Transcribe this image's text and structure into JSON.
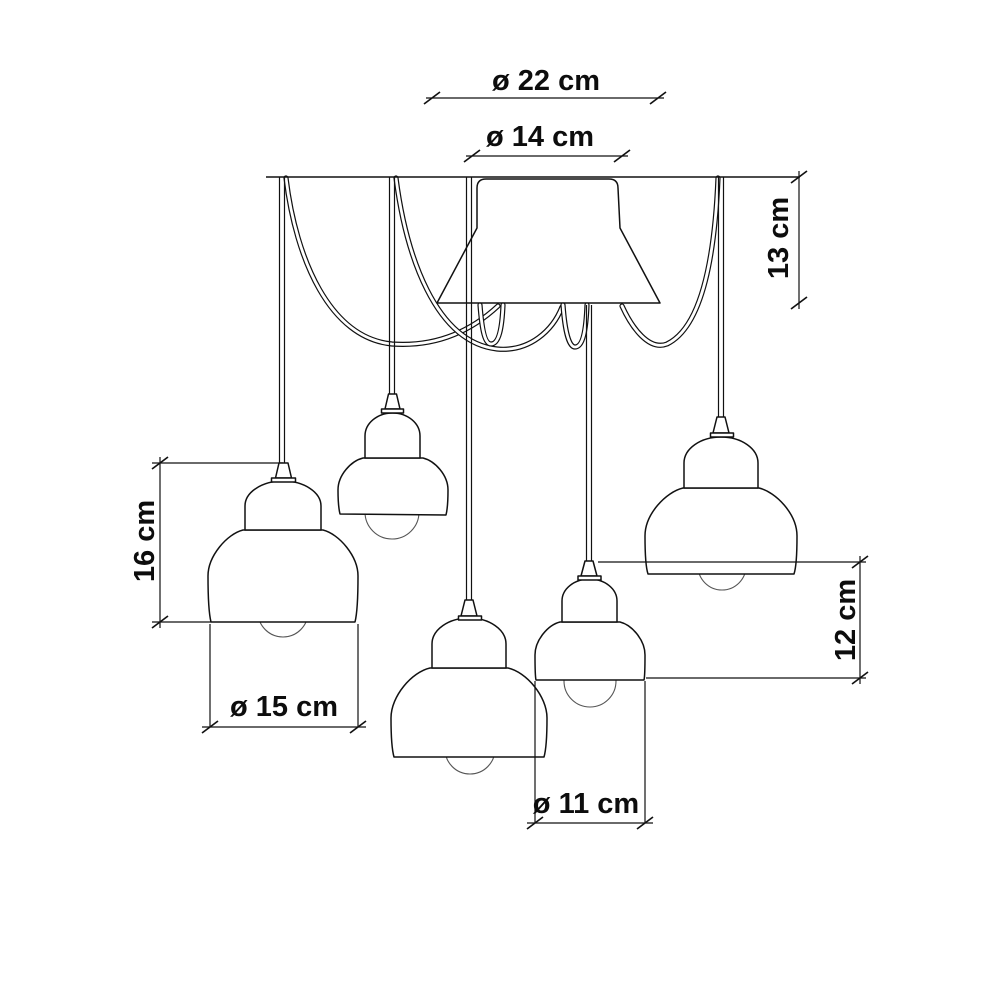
{
  "figure": {
    "type": "technical-dimension-drawing",
    "subject": "five-light multi-pendant ceiling chandelier with draped cables",
    "unit": "cm",
    "background_color": "#ffffff",
    "line_color": "#111111",
    "text_color": "#0d0d0d"
  },
  "labels": {
    "dia22": "ø 22 cm",
    "dia14": "ø 14 cm",
    "h13": "13 cm",
    "h16": "16 cm",
    "dia15": "ø 15 cm",
    "h12": "12 cm",
    "dia11": "ø 11 cm"
  },
  "dimensions": [
    {
      "name": "canopy-top-span",
      "label": "ø 22 cm",
      "value": 22,
      "unit": "cm"
    },
    {
      "name": "canopy-diameter",
      "label": "ø 14 cm",
      "value": 14,
      "unit": "cm"
    },
    {
      "name": "canopy-height",
      "label": "13 cm",
      "value": 13,
      "unit": "cm"
    },
    {
      "name": "large-shade-height",
      "label": "16 cm",
      "value": 16,
      "unit": "cm"
    },
    {
      "name": "large-shade-diameter",
      "label": "ø 15 cm",
      "value": 15,
      "unit": "cm"
    },
    {
      "name": "small-shade-height",
      "label": "12 cm",
      "value": 12,
      "unit": "cm"
    },
    {
      "name": "small-shade-diameter",
      "label": "ø 11 cm",
      "value": 11,
      "unit": "cm"
    }
  ],
  "components": {
    "canopy_count": 1,
    "pendant_count": 5,
    "large_pendants": 3,
    "small_pendants": 2
  }
}
